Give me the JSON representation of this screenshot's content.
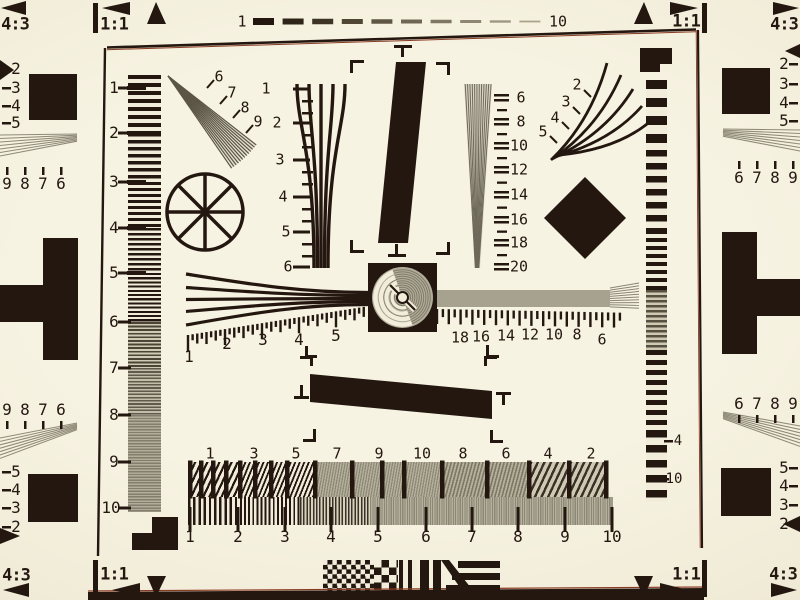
{
  "title": "ISO 12233 resolution test chart photograph",
  "colors": {
    "paper": "#f2eddb",
    "ink": "#241710",
    "gray_pattern": "#a49f8d",
    "gray_line": "#6e695a",
    "shadow_band": "#241710",
    "fringe_red": "#8a3a22"
  },
  "corner_markers": {
    "top_left_outer": "4:3",
    "top_left_inner": "1:1",
    "top_right_inner": "1:1",
    "top_right_outer": "4:3",
    "bottom_left_outer": "4:3",
    "bottom_left_inner": "1:1",
    "bottom_right_inner": "1:1",
    "bottom_right_outer": "4:3"
  },
  "top_dash_scale": {
    "start_label": "1",
    "end_label": "10"
  },
  "left_frequency_scale": [
    "1",
    "2",
    "3",
    "4",
    "5",
    "6",
    "7",
    "8",
    "9",
    "10"
  ],
  "upper_left_burst_labels": [
    "6",
    "7",
    "8",
    "9"
  ],
  "center_left_wedge_labels": [
    "1",
    "2",
    "3",
    "4",
    "5",
    "6"
  ],
  "center_right_wedge_labels": [
    "6",
    "8",
    "10",
    "12",
    "14",
    "16",
    "18",
    "20"
  ],
  "upper_right_burst_labels": [
    "2",
    "3",
    "4",
    "5"
  ],
  "horizontal_scale_left_labels": [
    "1",
    "2",
    "3",
    "4",
    "5"
  ],
  "horizontal_scale_right_labels": [
    "18",
    "16",
    "14",
    "12",
    "10",
    "8",
    "6"
  ],
  "right_column_labels": [
    "4",
    "10"
  ],
  "bottom_sweep_top_labels": [
    "1",
    "3",
    "5",
    "7",
    "9",
    "10",
    "8",
    "6",
    "4",
    "2"
  ],
  "bottom_sweep_bottom_labels": [
    "1",
    "2",
    "3",
    "4",
    "5",
    "6",
    "7",
    "8",
    "9",
    "10"
  ],
  "margin_left_top": {
    "column": [
      "2",
      "3",
      "4",
      "5"
    ],
    "row": [
      "9",
      "8",
      "7",
      "6"
    ]
  },
  "margin_left_bottom": {
    "row": [
      "9",
      "8",
      "7",
      "6"
    ],
    "column": [
      "5",
      "4",
      "3",
      "2"
    ]
  },
  "margin_right_top": {
    "column": [
      "2",
      "3",
      "4",
      "5"
    ],
    "row": [
      "6",
      "7",
      "8",
      "9"
    ]
  },
  "margin_right_bottom": {
    "row": [
      "6",
      "7",
      "8",
      "9"
    ],
    "column": [
      "5",
      "4",
      "3",
      "2"
    ]
  }
}
